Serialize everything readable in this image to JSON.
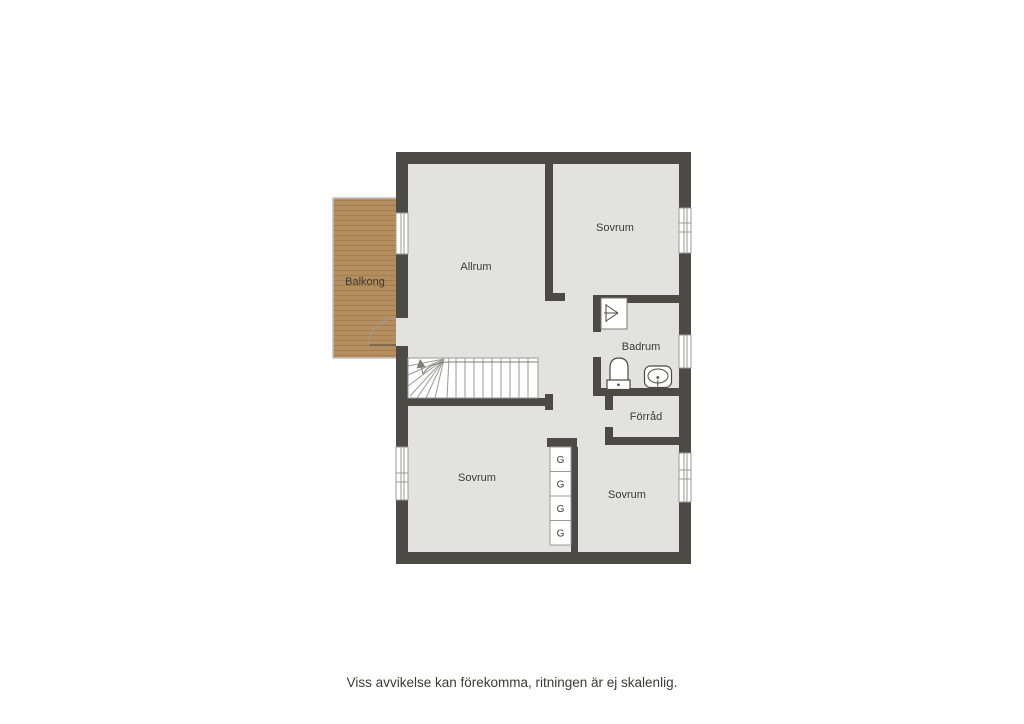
{
  "title": "Floor plan",
  "rooms": {
    "allrum": "Allrum",
    "sovrum_top_right": "Sovrum",
    "sovrum_bottom_left": "Sovrum",
    "sovrum_bottom_right": "Sovrum",
    "badrum": "Badrum",
    "forrad": "Förråd",
    "balkong": "Balkong"
  },
  "closet": {
    "label": "G",
    "count": 4
  },
  "fixtures": [
    "stairs",
    "shower",
    "toilet",
    "sink",
    "balcony-door"
  ],
  "disclaimer": "Viss avvikelse kan förekomma, ritningen är ej skalenlig.",
  "colors": {
    "wall": "#4b4a45",
    "floor": "#e2e2e0",
    "balcony_wood": "#b48e5f",
    "balcony_wood_stripe": "#a37d50",
    "line": "#9a9a98",
    "fixture_line": "#4b4a45",
    "text": "#3b3b39",
    "background": "#ffffff"
  }
}
